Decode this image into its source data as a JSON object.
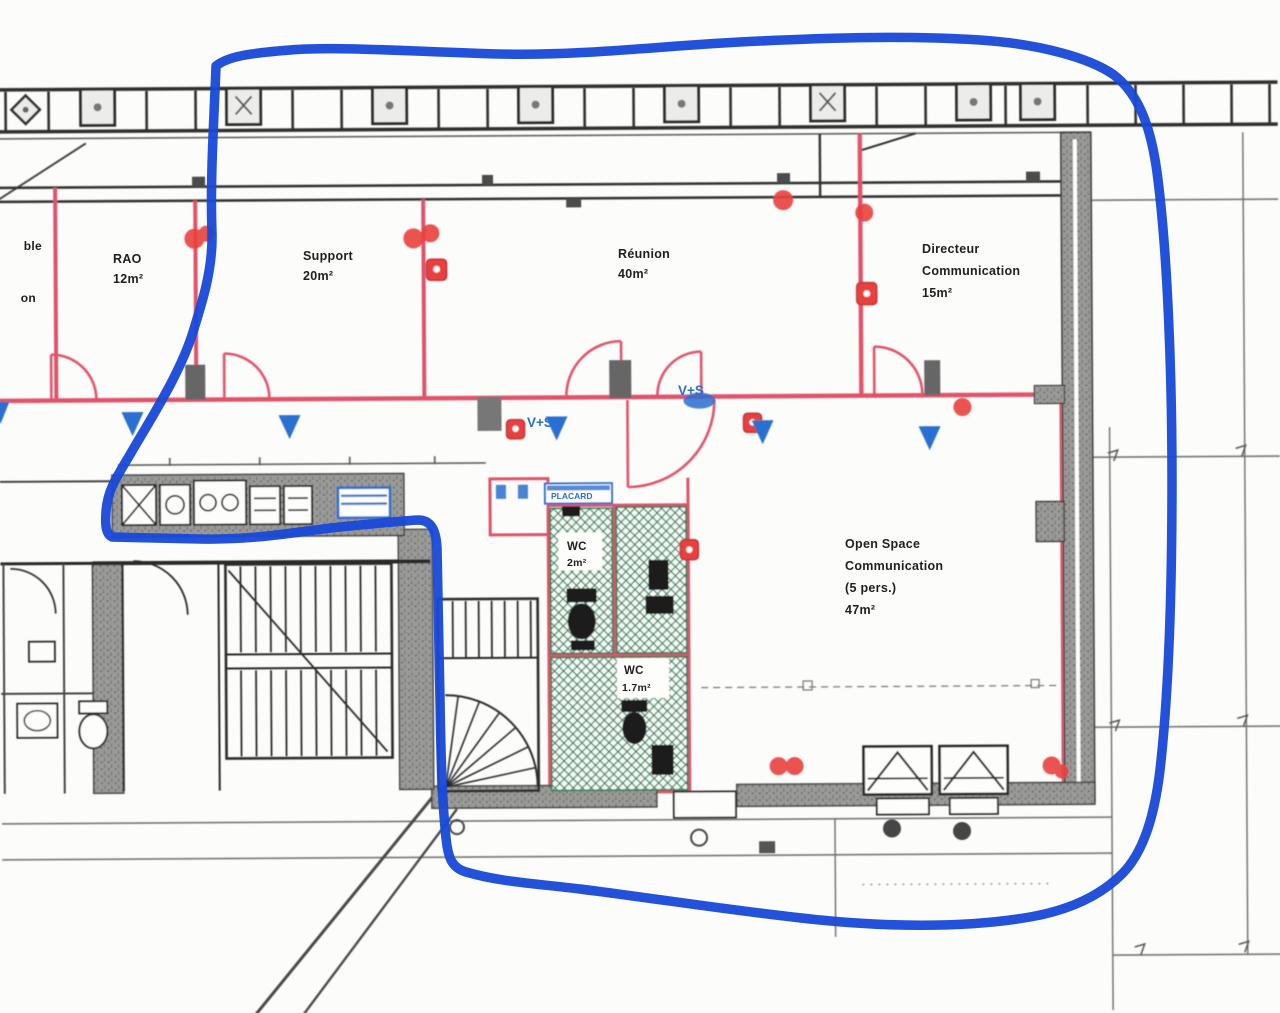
{
  "document": {
    "type": "scanned-floor-plan",
    "annotation": {
      "tool": "freehand-marker-loop",
      "color": "#1848d8"
    }
  },
  "palette": {
    "ink": "#2c2c2c",
    "paper": "#fcfcfa",
    "partition_pink": "#e0526a",
    "marker_red": "#e8413f",
    "symbol_blue": "#2b6fd0",
    "hatch_green": "#2f7d5a",
    "wall_gray": "#9a9a98"
  },
  "rooms": [
    {
      "id": "rao",
      "lines": [
        "RAO",
        "12m²"
      ]
    },
    {
      "id": "support",
      "lines": [
        "Support",
        "20m²"
      ]
    },
    {
      "id": "reunion",
      "lines": [
        "Réunion",
        "40m²"
      ]
    },
    {
      "id": "directeur",
      "lines": [
        "Directeur",
        "Communication",
        "15m²"
      ]
    },
    {
      "id": "open-space",
      "lines": [
        "Open Space",
        "Communication",
        "(5 pers.)",
        "47m²"
      ]
    },
    {
      "id": "wc-1",
      "lines": [
        "WC",
        "2m²"
      ]
    },
    {
      "id": "wc-2",
      "lines": [
        "WC",
        "1.7m²"
      ]
    }
  ],
  "small_labels": {
    "vs_1": "V+S",
    "vs_2": "V+S",
    "placard": "PLACARD",
    "edge_fragment_1": "ble",
    "edge_fragment_2": "on"
  }
}
